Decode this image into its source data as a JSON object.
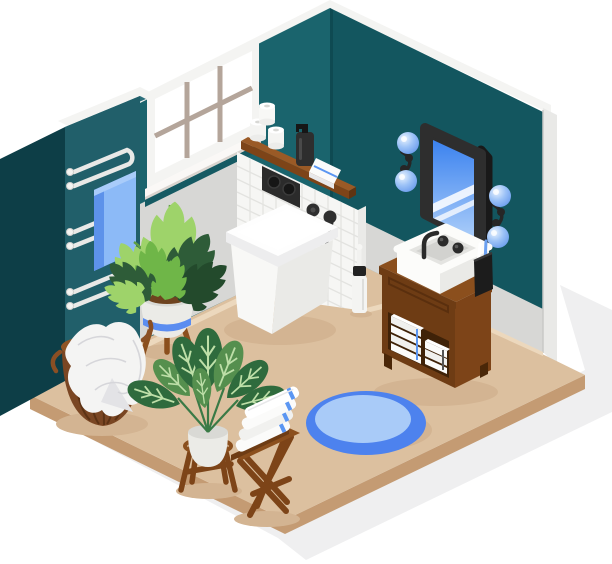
{
  "meta": {
    "title": "Isometric bathroom interior illustration",
    "canvas": {
      "width": 612,
      "height": 564
    }
  },
  "palette": {
    "bg": "#ffffff",
    "groundShadow": "#efeff0",
    "tealLeftWall": "#1a646d",
    "tealRightWall": "#13565f",
    "tealColumnFront": "#215f6a",
    "tealColumnSide": "#0d3e47",
    "tealColumnTop": "#2b6f7b",
    "tealStrip": "#155a63",
    "cornerSeam": "#0e4a52",
    "wallGray": "#d7d7d5",
    "rimWhite": "#f4f4f2",
    "wallEdge": "#e9e9e7",
    "edgeGray": "#c9c9c7",
    "floorTan": "#dcc09f",
    "floorSide": "#c49b73",
    "floorStrip": "#ecd8bd",
    "itemShadow": "#d3b492",
    "tile": "#f6f6f4",
    "tileGrout": "#e3e3e0",
    "tileSide": "#eaeae8",
    "woodDark": "#5f3412",
    "wood": "#6e3c14",
    "woodMid": "#7d4418",
    "woodLight": "#8b4f1d",
    "woodTop": "#9a5a26",
    "porcelain": "#fcfcfa",
    "porcelainShade": "#eaeae7",
    "porcelainDeep": "#dfdfdc",
    "basinInner": "#e4e4e1",
    "basinDeep": "#d2d2cf",
    "towel": "#fbfbfa",
    "towelShade": "#e8e8ea",
    "stripeBlue": "#5b96f2",
    "stripeDark": "#555555",
    "blueTowel": "#8cbaf7",
    "blueTowelFold": "#5d92ea",
    "blueTowelLight": "#a9ccfa",
    "pipe": "#e9e9e7",
    "pipeStud": "#f3f3f1",
    "rugOuter": "#4d82ee",
    "rugInner": "#a9cbf8",
    "fixtureBlack": "#2b2b2b",
    "fixtureDeep": "#161616",
    "frameBlack": "#2e2e2e",
    "frameSide": "#191919",
    "glassTop": "#3b82ef",
    "glassBottom": "#a9ccf9",
    "glassStripe": "#ffffff",
    "greenLight": "#9ed36a",
    "green": "#6fb648",
    "greenDark": "#2e5c38",
    "greenDeep": "#234a2c",
    "stem": "#5f9e44",
    "calathea": "#2f6b3d",
    "calatheaLight": "#558f4e",
    "leafVein": "#bedfa8",
    "basket": "#7a4623",
    "basketDark": "#5c3214",
    "basketRim": "#8f5526",
    "basketInner": "#6b3a16",
    "basketHandle": "#8a4f24",
    "soil": "#6e431f",
    "pot": "#ebebe7",
    "potShade": "#d9d9d5",
    "potStripe": "#5b8df0",
    "cloth": "#f4f4f3",
    "clothShade": "#e3e3e6",
    "clothLine": "#d6d6da"
  },
  "scene": {
    "room": "Isometric corner bathroom with dark teal upper walls, gray lower walls, white tiled plumbing wall and tan floor on a white background with soft gray ground shadow",
    "objects": [
      {
        "name": "window",
        "description": "Six-pane window with white frame and taupe mullions on the back-left teal wall"
      },
      {
        "name": "towel-radiator",
        "description": "White serpentine towel radiator mounted on teal wall column"
      },
      {
        "name": "radiator-towel",
        "description": "Light blue towel hanging on the radiator"
      },
      {
        "name": "monstera-plant",
        "description": "Monstera in striped white pot on wooden tripod stand"
      },
      {
        "name": "laundry-basket",
        "description": "Brown wicker basket with white cloth draped over it"
      },
      {
        "name": "tiled-wall",
        "description": "White square-tiled plumbing column behind toilet"
      },
      {
        "name": "toilet",
        "description": "White wall-hung square toilet"
      },
      {
        "name": "flush-plate",
        "description": "Black dual flush plate on the tile"
      },
      {
        "name": "wall-shelf",
        "description": "Wooden shelf above toilet"
      },
      {
        "name": "toilet-paper-rolls",
        "description": "Three white toilet paper rolls on the shelf"
      },
      {
        "name": "soap-dispenser",
        "description": "Black pump soap dispenser on the shelf"
      },
      {
        "name": "shelf-towel",
        "description": "Folded white towel with blue stripe on the shelf"
      },
      {
        "name": "shower-head",
        "description": "Black handheld shower on bracket with hanging hose"
      },
      {
        "name": "toilet-brush",
        "description": "White toilet brush with black collar"
      },
      {
        "name": "mirror",
        "description": "Black rounded-frame mirror with blue glass and diagonal reflections"
      },
      {
        "name": "wall-sconces",
        "description": "Two double blue-globe sconces with black brackets"
      },
      {
        "name": "vanity-cabinet",
        "description": "Brown wooden vanity with open shelf of folded towels"
      },
      {
        "name": "vessel-sink",
        "description": "White rectangular vessel sink"
      },
      {
        "name": "faucet",
        "description": "Black wall-mounted faucet with two round handles"
      },
      {
        "name": "toothbrush-cup",
        "description": "Black cup with two toothbrushes"
      },
      {
        "name": "round-rug",
        "description": "Round two-tone blue rug"
      },
      {
        "name": "calathea-plant",
        "description": "Dark green striped-leaf plant in white pot on wooden stand"
      },
      {
        "name": "stool-towels",
        "description": "Stack of four white towels with blue stripes on a wooden folding stool"
      }
    ]
  }
}
